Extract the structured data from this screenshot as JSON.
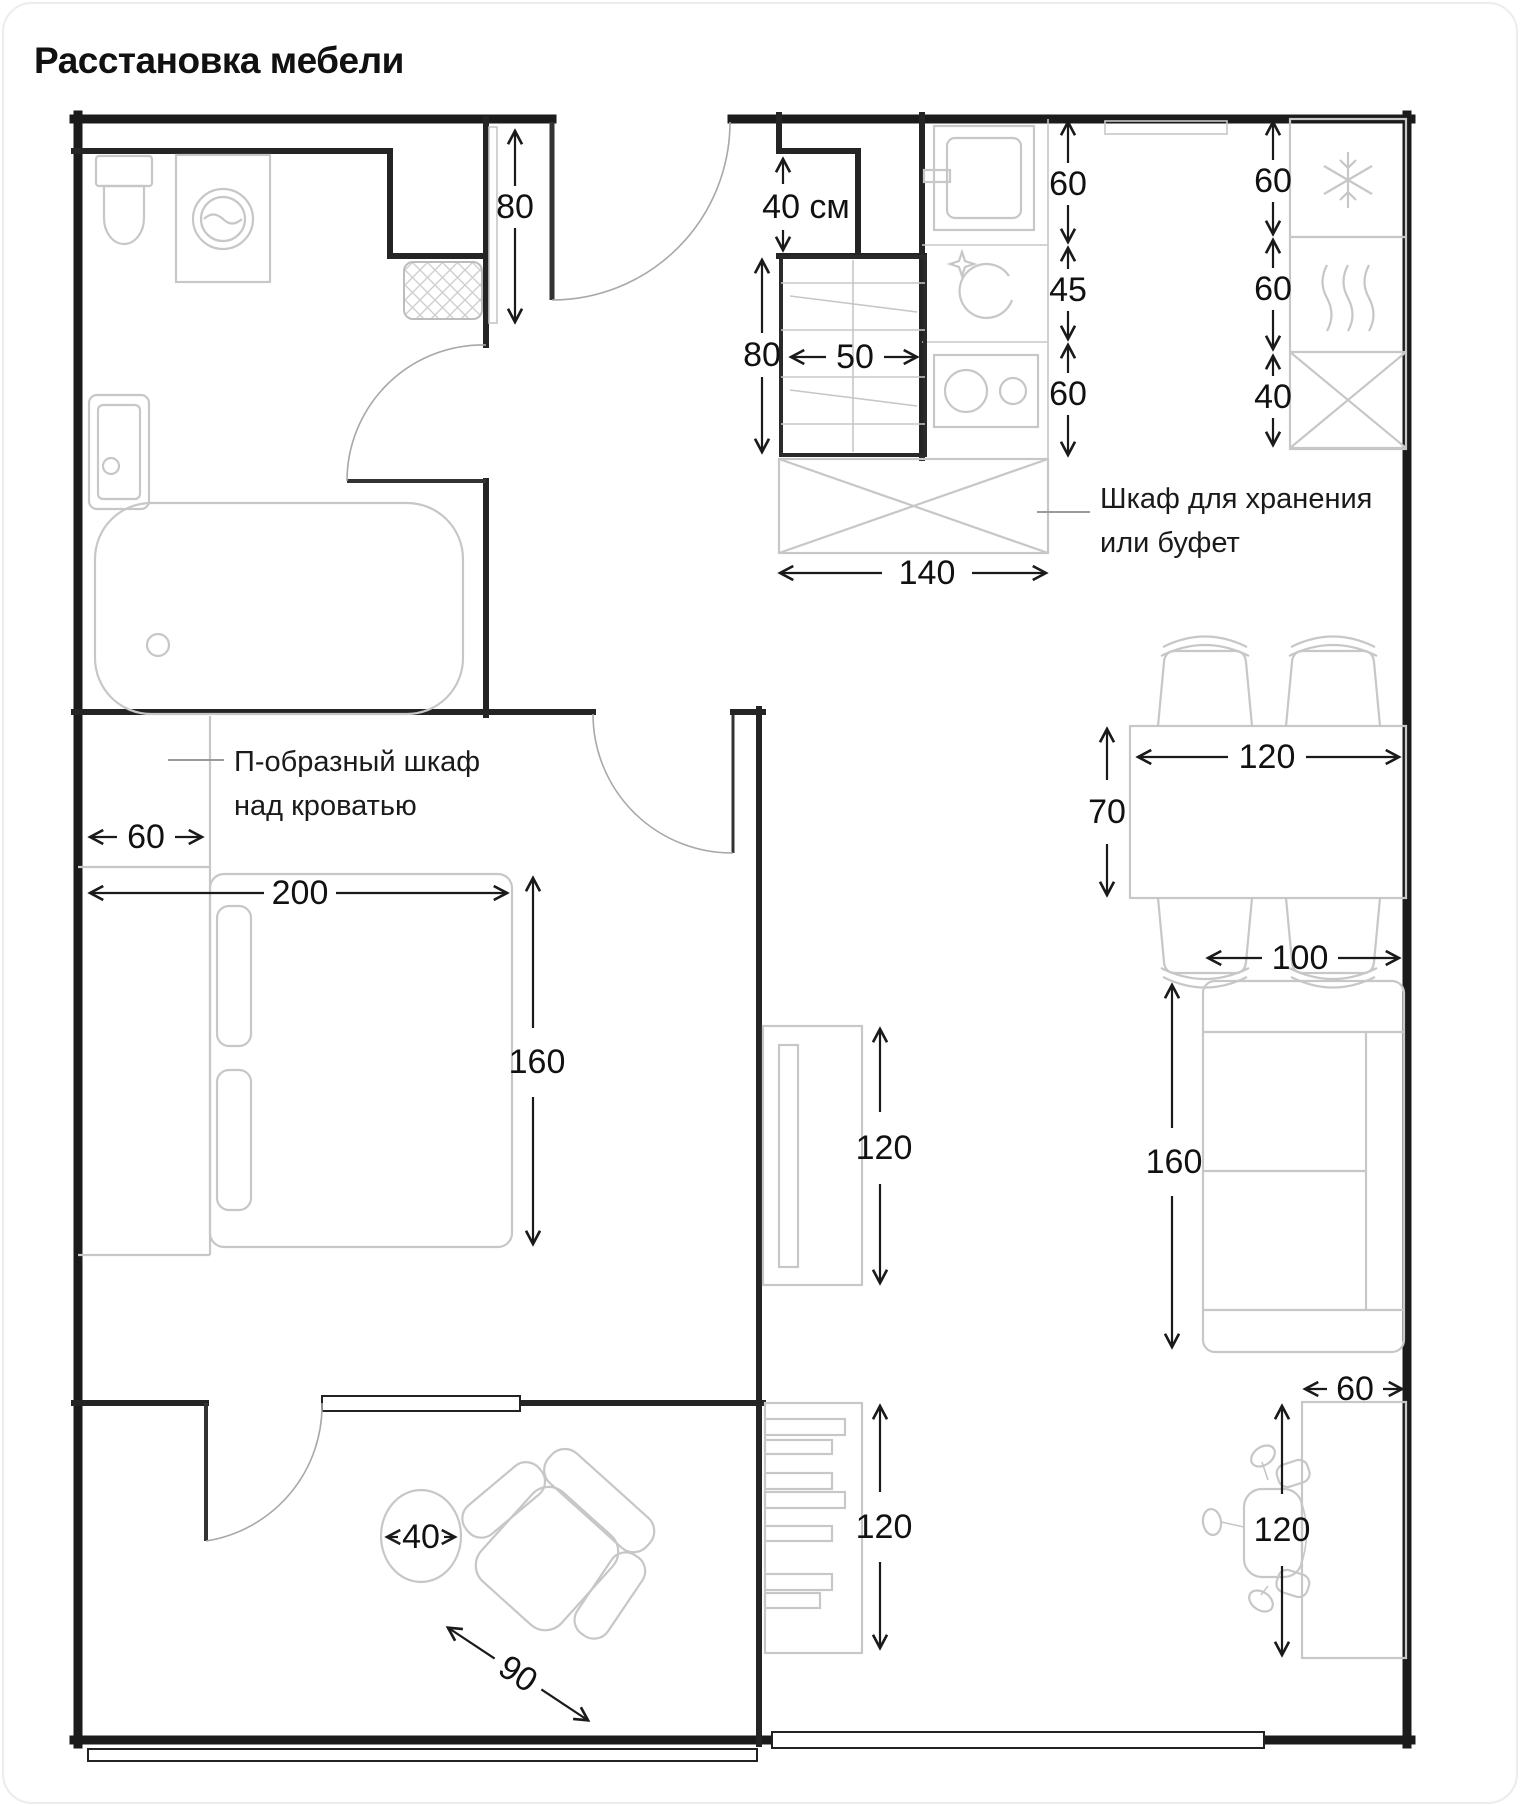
{
  "title": "Расстановка мебели",
  "plan": {
    "annotations": {
      "storage_line1": "Шкаф для хранения",
      "storage_line2": "или буфет",
      "wardrobe_line1": "П-образный шкаф",
      "wardrobe_line2": "над кроватью"
    },
    "dimensions": {
      "entry_niche": "80",
      "duct_niche": "40 см",
      "kitchen_cabinet_depth": "80",
      "kitchen_cabinet_width": "50",
      "sink_width": "60",
      "dishwasher_width": "45",
      "stove_width": "60",
      "buffet_width": "140",
      "freezer_width": "60",
      "oven_width": "60",
      "tall_cabinet_width": "40",
      "wardrobe_depth": "60",
      "bed_length": "200",
      "bed_width": "160",
      "table_depth": "70",
      "table_width": "120",
      "sofa_width": "100",
      "sofa_length": "160",
      "tv_console_length": "120",
      "shelf_length": "120",
      "desk_width": "60",
      "desk_length": "120",
      "balcony_table_diameter": "40",
      "armchair_width": "90"
    },
    "icons": {
      "freezer": "snowflake-icon",
      "oven": "steam-waves-icon",
      "dishwasher": "sparkle-wash-icon",
      "storage_box": "crossed-box-icon",
      "mat": "crosshatch-mat-icon"
    },
    "colors": {
      "wall": "#1b1b1b",
      "furniture": "#c7c7c7",
      "dimension": "#1a1a1a",
      "background": "#ffffff"
    }
  }
}
